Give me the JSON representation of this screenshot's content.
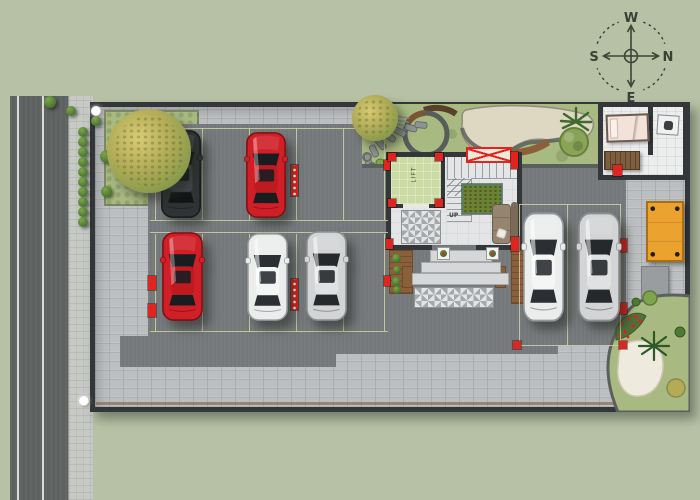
{
  "scene": {
    "width": 700,
    "height": 500,
    "description": "Top-view ground-floor site plan: street on west side, walled plot with paver compound, parking stalls with seven cars, central stair-and-lift core with entrance steps, landscaped gardens, caretaker room and timber deck"
  },
  "palette": {
    "sage": "#b7c1a5",
    "road": "#5d615f",
    "roadline": "#f1f1ec",
    "sidewalk": "#c7c9c5",
    "paver": "#bcbfc1",
    "asphalt": "#75787a",
    "wall": "#33373a",
    "lawn": "#a8b981",
    "gravel": "#ded7c2",
    "sand": "#eeeade",
    "red": "#e0241f",
    "stall": "#c9cf9e",
    "lift": "#ccdaa4",
    "floor": "#e4e5e6",
    "tilea": "#e3e4e5",
    "tileb": "#a4a8aa",
    "wood": "#8a5f3b",
    "wooddark": "#6e4a2c",
    "deck": "#eca22f",
    "deckedge": "#a87014",
    "rug": "#6d8132",
    "sofa": "#95846f",
    "bed": "#f2e2d9",
    "bench": "#7d5e3f",
    "edging": "#5c605c"
  },
  "compass": {
    "top": "W",
    "left": "S",
    "right": "N",
    "bottom": "E"
  },
  "labels": {
    "stairs_up": "UP",
    "lift": "LIFT"
  },
  "cars": [
    {
      "id": "car-1",
      "color": "black",
      "x": 159,
      "y": 129,
      "w": 44,
      "h": 90
    },
    {
      "id": "car-2",
      "color": "red",
      "x": 244,
      "y": 131,
      "w": 44,
      "h": 88
    },
    {
      "id": "car-3",
      "color": "red",
      "x": 160,
      "y": 231,
      "w": 45,
      "h": 91
    },
    {
      "id": "car-4",
      "color": "white",
      "x": 245,
      "y": 232,
      "w": 45,
      "h": 90
    },
    {
      "id": "car-5",
      "color": "silver",
      "x": 304,
      "y": 230,
      "w": 45,
      "h": 92
    },
    {
      "id": "car-6",
      "color": "white",
      "x": 521,
      "y": 211,
      "w": 45,
      "h": 112
    },
    {
      "id": "car-7",
      "color": "silver",
      "x": 576,
      "y": 211,
      "w": 46,
      "h": 112
    }
  ],
  "car_colors": {
    "black": {
      "body": "#303335",
      "edge": "#17191b",
      "glass": "#121416",
      "roof": "#43474a",
      "shine": "rgba(255,255,255,.16)"
    },
    "red": {
      "body": "#d01f26",
      "edge": "#7e1014",
      "glass": "#1a1d20",
      "roof": "#c01a21",
      "shine": "rgba(255,255,255,.32)"
    },
    "white": {
      "body": "#ebecec",
      "edge": "#93969a",
      "glass": "#2b2f33",
      "roof": "#f4f5f5",
      "shine": "rgba(255,255,255,.55)"
    },
    "silver": {
      "body": "#d2d4d5",
      "edge": "#8b8e90",
      "glass": "#26292c",
      "roof": "#dfe1e2",
      "shine": "rgba(255,255,255,.5)"
    }
  },
  "parking": {
    "stall_lines": [
      {
        "x": 155,
        "y": 128,
        "w": 1,
        "h": 92
      },
      {
        "x": 202,
        "y": 128,
        "w": 1,
        "h": 92
      },
      {
        "x": 249,
        "y": 128,
        "w": 1,
        "h": 92
      },
      {
        "x": 296,
        "y": 128,
        "w": 1,
        "h": 92
      },
      {
        "x": 343,
        "y": 128,
        "w": 1,
        "h": 92
      },
      {
        "x": 384,
        "y": 128,
        "w": 1,
        "h": 92
      },
      {
        "x": 155,
        "y": 234,
        "w": 1,
        "h": 98
      },
      {
        "x": 202,
        "y": 234,
        "w": 1,
        "h": 98
      },
      {
        "x": 249,
        "y": 234,
        "w": 1,
        "h": 98
      },
      {
        "x": 296,
        "y": 234,
        "w": 1,
        "h": 98
      },
      {
        "x": 343,
        "y": 234,
        "w": 1,
        "h": 98
      },
      {
        "x": 384,
        "y": 234,
        "w": 1,
        "h": 98
      },
      {
        "x": 150,
        "y": 128,
        "w": 238,
        "h": 1
      },
      {
        "x": 150,
        "y": 220,
        "w": 238,
        "h": 1
      },
      {
        "x": 150,
        "y": 232,
        "w": 238,
        "h": 1
      },
      {
        "x": 150,
        "y": 331,
        "w": 238,
        "h": 1
      },
      {
        "x": 519,
        "y": 204,
        "w": 1,
        "h": 142
      },
      {
        "x": 567,
        "y": 204,
        "w": 1,
        "h": 142
      },
      {
        "x": 620,
        "y": 204,
        "w": 1,
        "h": 142
      },
      {
        "x": 519,
        "y": 204,
        "w": 102,
        "h": 1
      },
      {
        "x": 519,
        "y": 345,
        "w": 102,
        "h": 1
      }
    ],
    "red_markers": [
      {
        "x": 148,
        "y": 162,
        "w": 8,
        "h": 14
      },
      {
        "x": 148,
        "y": 276,
        "w": 8,
        "h": 14
      },
      {
        "x": 148,
        "y": 304,
        "w": 8,
        "h": 13
      },
      {
        "x": 384,
        "y": 160,
        "w": 6,
        "h": 10
      },
      {
        "x": 384,
        "y": 276,
        "w": 6,
        "h": 10
      },
      {
        "x": 511,
        "y": 237,
        "w": 8,
        "h": 14
      },
      {
        "x": 616,
        "y": 239,
        "w": 11,
        "h": 13
      },
      {
        "x": 616,
        "y": 303,
        "w": 11,
        "h": 11
      },
      {
        "x": 513,
        "y": 341,
        "w": 8,
        "h": 8
      },
      {
        "x": 619,
        "y": 341,
        "w": 8,
        "h": 8
      },
      {
        "x": 388,
        "y": 153,
        "w": 8,
        "h": 8
      },
      {
        "x": 435,
        "y": 153,
        "w": 8,
        "h": 8
      },
      {
        "x": 388,
        "y": 199,
        "w": 8,
        "h": 8
      },
      {
        "x": 435,
        "y": 199,
        "w": 8,
        "h": 8
      },
      {
        "x": 511,
        "y": 152,
        "w": 7,
        "h": 17
      },
      {
        "x": 386,
        "y": 239,
        "w": 7,
        "h": 10
      },
      {
        "x": 613,
        "y": 165,
        "w": 9,
        "h": 11
      }
    ],
    "red_columns": [
      {
        "x": 291,
        "y": 165,
        "w": 7,
        "h": 31
      },
      {
        "x": 291,
        "y": 279,
        "w": 7,
        "h": 31
      }
    ]
  },
  "landscape": {
    "sidewalk_bushes": [
      {
        "x": 78,
        "y": 127,
        "s": 10
      },
      {
        "x": 78,
        "y": 137,
        "s": 10
      },
      {
        "x": 78,
        "y": 147,
        "s": 10
      },
      {
        "x": 78,
        "y": 157,
        "s": 10
      },
      {
        "x": 78,
        "y": 167,
        "s": 10
      },
      {
        "x": 78,
        "y": 177,
        "s": 10
      },
      {
        "x": 78,
        "y": 187,
        "s": 10
      },
      {
        "x": 78,
        "y": 197,
        "s": 10
      },
      {
        "x": 78,
        "y": 207,
        "s": 10
      },
      {
        "x": 78,
        "y": 217,
        "s": 10
      },
      {
        "x": 44,
        "y": 96,
        "s": 12
      },
      {
        "x": 66,
        "y": 106,
        "s": 10
      },
      {
        "x": 91,
        "y": 116,
        "s": 10
      },
      {
        "x": 100,
        "y": 150,
        "s": 13
      },
      {
        "x": 101,
        "y": 186,
        "s": 11
      }
    ],
    "trees": [
      {
        "x": 107,
        "y": 109,
        "s": 84
      },
      {
        "x": 352,
        "y": 95,
        "s": 46
      }
    ],
    "street_lights": [
      {
        "x": 91,
        "y": 106,
        "s": 10
      },
      {
        "x": 79,
        "y": 396,
        "s": 10
      }
    ]
  }
}
